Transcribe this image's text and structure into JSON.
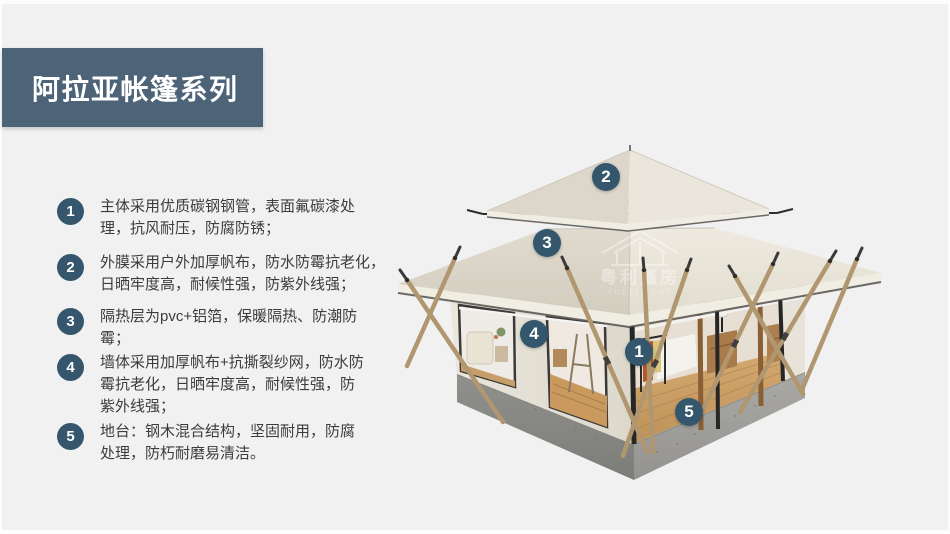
{
  "title": {
    "text": "阿拉亚帐篷系列"
  },
  "features": [
    {
      "num": "1",
      "lines": [
        "主体采用优质碳钢钢管，表面氟碳漆处",
        "理，抗风耐压，防腐防锈；"
      ]
    },
    {
      "num": "2",
      "lines": [
        "外膜采用户外加厚帆布，防水防霉抗老化，",
        "日晒牢度高，耐候性强，防紫外线强；"
      ]
    },
    {
      "num": "3",
      "lines": [
        "隔热层为pvc+铝箔，保暖隔热、防潮防",
        "霉；"
      ]
    },
    {
      "num": "4",
      "lines": [
        "墙体采用加厚帆布+抗撕裂纱网，防水防",
        "霉抗老化，日晒牢度高，耐候性强，防",
        "紫外线强；"
      ]
    },
    {
      "num": "5",
      "lines": [
        "地台：钢木混合结构，坚固耐用，防腐",
        "处理，防朽耐磨易清洁。"
      ]
    }
  ],
  "callouts": [
    {
      "num": "1"
    },
    {
      "num": "2"
    },
    {
      "num": "3"
    },
    {
      "num": "4"
    },
    {
      "num": "5"
    }
  ],
  "watermark": {
    "brand": "粤利篷房",
    "brand_latin": "YUELI TENT"
  },
  "colors": {
    "background": "#f1f1f2",
    "banner": "#4d6377",
    "badge": "#35566c",
    "text": "#3c3c3c",
    "roof_canvas": "#ece8dd",
    "platform": "#90908c",
    "wood_pole": "#b1976f"
  }
}
